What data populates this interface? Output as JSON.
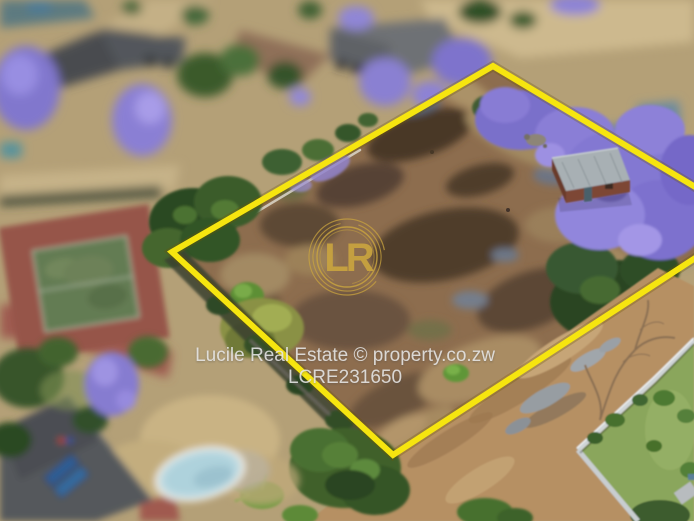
{
  "photo": {
    "description": "Aerial drone photograph of a vacant residential stand outlined in yellow, jacaranda trees in bloom, tennis court and houses around it",
    "watermark": {
      "line1": "Lucile Real Estate © property.co.zw",
      "line2": "LCRE231650"
    },
    "logo": {
      "monogram": "LR"
    },
    "boundary": {
      "points": "172,252 493,66 752,221 393,455"
    }
  },
  "colors": {
    "boundary-yellow": "#f6e50f",
    "logo-gold": "#c9a43f",
    "wm-text": "#e6e6e6"
  }
}
